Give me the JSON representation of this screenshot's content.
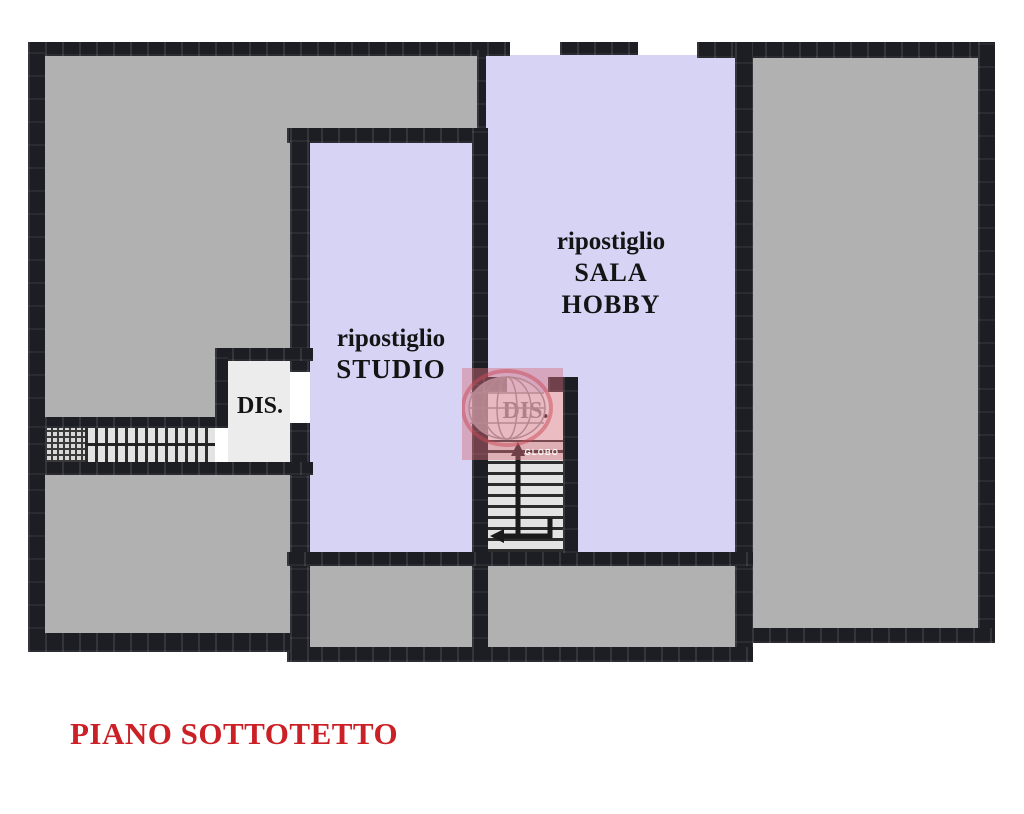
{
  "page_title": "PIANO SOTTOTETTO",
  "plan": {
    "rooms": {
      "storage_study": {
        "line1": "ripostiglio",
        "line2": "STUDIO"
      },
      "storage_hobby_room": {
        "line1": "ripostiglio",
        "line2": "SALA",
        "line3": "HOBBY"
      },
      "hallway_left": {
        "label": "DIS."
      },
      "hallway_center": {
        "label": "DIS."
      },
      "unlabeled_rooms": [
        "top-left room",
        "left bottom room",
        "below-studio room",
        "below-hobby room",
        "right room"
      ]
    },
    "features": [
      "left staircase",
      "central staircase with down arrow",
      "door opening studio-hallway",
      "two openings in top wall"
    ]
  },
  "watermark": {
    "label": "GLOBO"
  },
  "colors": {
    "wall": "#1d1d24",
    "room_gray": "#b1b1b1",
    "room_lavender": "#d6d3f5",
    "room_light": "#ececec",
    "title_red": "#cb2026",
    "watermark_pink": "#d66e7d"
  }
}
